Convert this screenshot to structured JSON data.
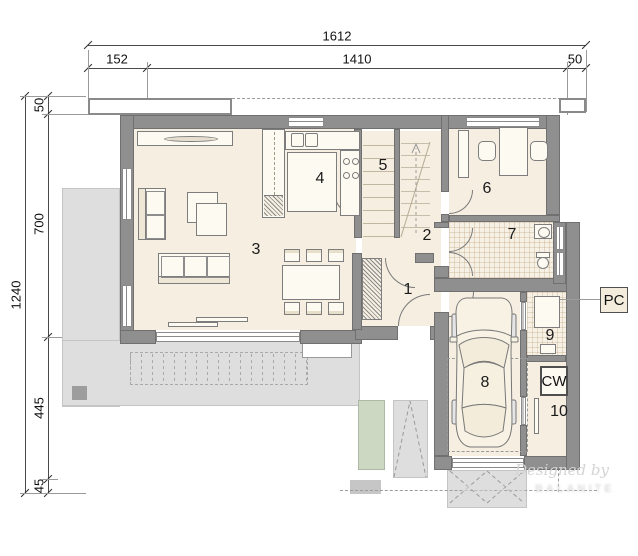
{
  "title": "House ground-floor architectural plan",
  "dims": {
    "top": {
      "total": "1612",
      "segments": [
        "152",
        "1410",
        "50"
      ]
    },
    "left": {
      "total": "1240",
      "segments": [
        "50",
        "700",
        "445",
        "45"
      ]
    }
  },
  "rooms": [
    "1",
    "2",
    "3",
    "4",
    "5",
    "6",
    "7",
    "8",
    "9",
    "10"
  ],
  "labels": {
    "pc": "PC",
    "cw": "CW"
  },
  "watermark": {
    "line1": "Designed by",
    "line2": "MARONE BALANITE"
  },
  "colors": {
    "wall": "#8f8f8f",
    "floor": "#f5eee1",
    "tile_floor": "#f7f1e5",
    "terrace": "#dedede",
    "lawn": "#ccd8c2",
    "dimension_text": "#111111"
  },
  "furniture": [
    "tv-cabinet",
    "sofa-2seat",
    "sofa-3seat",
    "coffee-tables",
    "dining-table",
    "dining-chairs",
    "kitchen-counter",
    "kitchen-island",
    "sink",
    "stove",
    "tall-cabinet",
    "pantry-shelves",
    "stairs",
    "wardrobe",
    "desk",
    "office-chairs",
    "shelf",
    "bathroom-sink",
    "toilet",
    "boiler",
    "cw-unit",
    "car"
  ]
}
